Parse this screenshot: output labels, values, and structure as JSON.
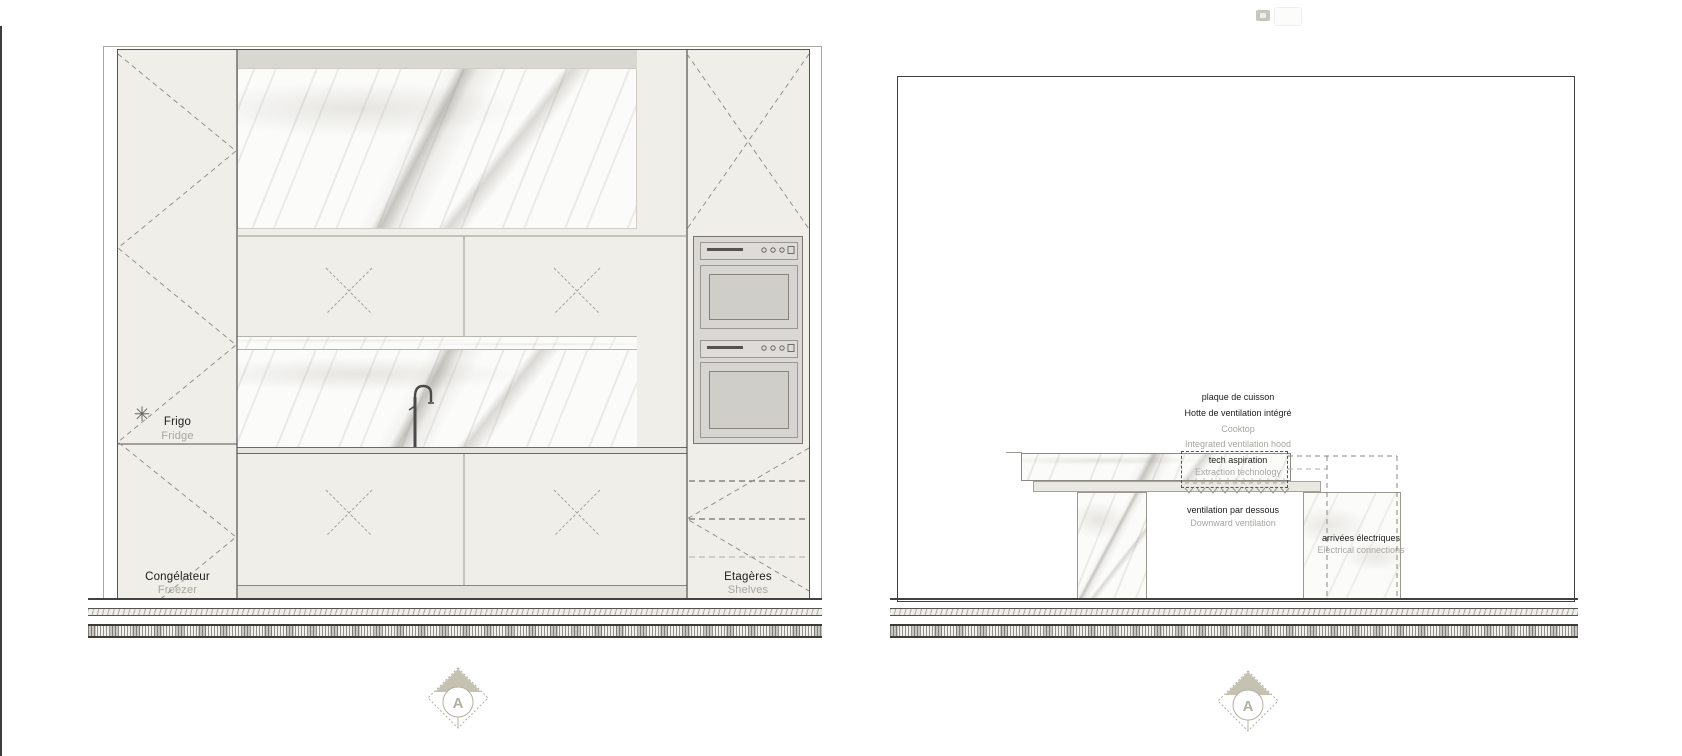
{
  "colors": {
    "panel_cream": "#efeee9",
    "line_dark": "#55534e",
    "gray_text": "#a8a6a0",
    "taupe_accent": "#c6c2b2",
    "oven_gray": "#d9d8d4",
    "soffit_gray": "#d8d7d2"
  },
  "left_elevation": {
    "snowflake_glyph": "✳",
    "labels": {
      "fridge_fr": "Frigo",
      "fridge_en": "Fridge",
      "freezer_fr": "Congélateur",
      "freezer_en": "Freezer",
      "shelves_fr": "Etagères",
      "shelves_en": "Shelves"
    }
  },
  "right_section": {
    "annotations": {
      "cooktop_fr": "plaque de cuisson",
      "hood_fr": "Hotte de ventilation intégré",
      "cooktop_en": "Cooktop",
      "hood_en": "Integrated ventilation hood",
      "extraction_fr": "tech aspiration",
      "extraction_en": "Extraction technology",
      "downdraft_fr": "ventilation par dessous",
      "downdraft_en": "Downward ventilation",
      "electrical_fr": "arrivées électriques",
      "electrical_en": "Electrical connections"
    }
  },
  "section_markers": {
    "left": "A",
    "right": "A"
  }
}
